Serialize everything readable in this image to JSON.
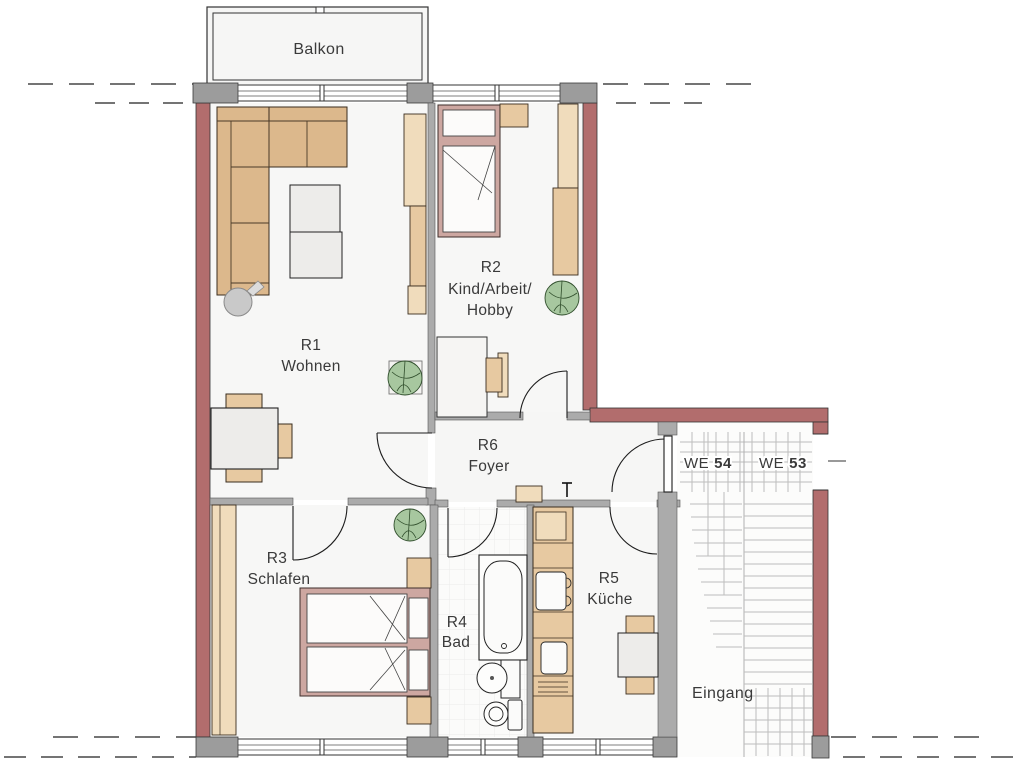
{
  "floorplan": {
    "balcony_label": "Balkon",
    "rooms": {
      "r1": {
        "id": "R1",
        "label": "Wohnen"
      },
      "r2": {
        "id": "R2",
        "label_line1": "Kind/Arbeit/",
        "label_line2": "Hobby"
      },
      "r3": {
        "id": "R3",
        "label": "Schlafen"
      },
      "r4": {
        "id": "R4",
        "label": "Bad"
      },
      "r5": {
        "id": "R5",
        "label": "Küche"
      },
      "r6": {
        "id": "R6",
        "label": "Foyer"
      }
    },
    "units": {
      "we54": {
        "prefix": "WE",
        "number": "54"
      },
      "we53": {
        "prefix": "WE",
        "number": "53"
      }
    },
    "entrance_label": "Eingang"
  },
  "colors": {
    "exterior_wall": "#b26d6d",
    "interior_wall": "#ababab",
    "pier": "#9c9c9c",
    "wood": "#e7c9a1",
    "wood_light": "#f0dcbc",
    "sofa": "#dcb88c",
    "bed_frame": "#cda7a1",
    "mattress": "#fcfbfa",
    "plant": "#a7c79f",
    "table": "#edecea",
    "floor": "#f8f8f7",
    "stair_lines": "#bdbdbd",
    "text": "#3a3a3a"
  }
}
